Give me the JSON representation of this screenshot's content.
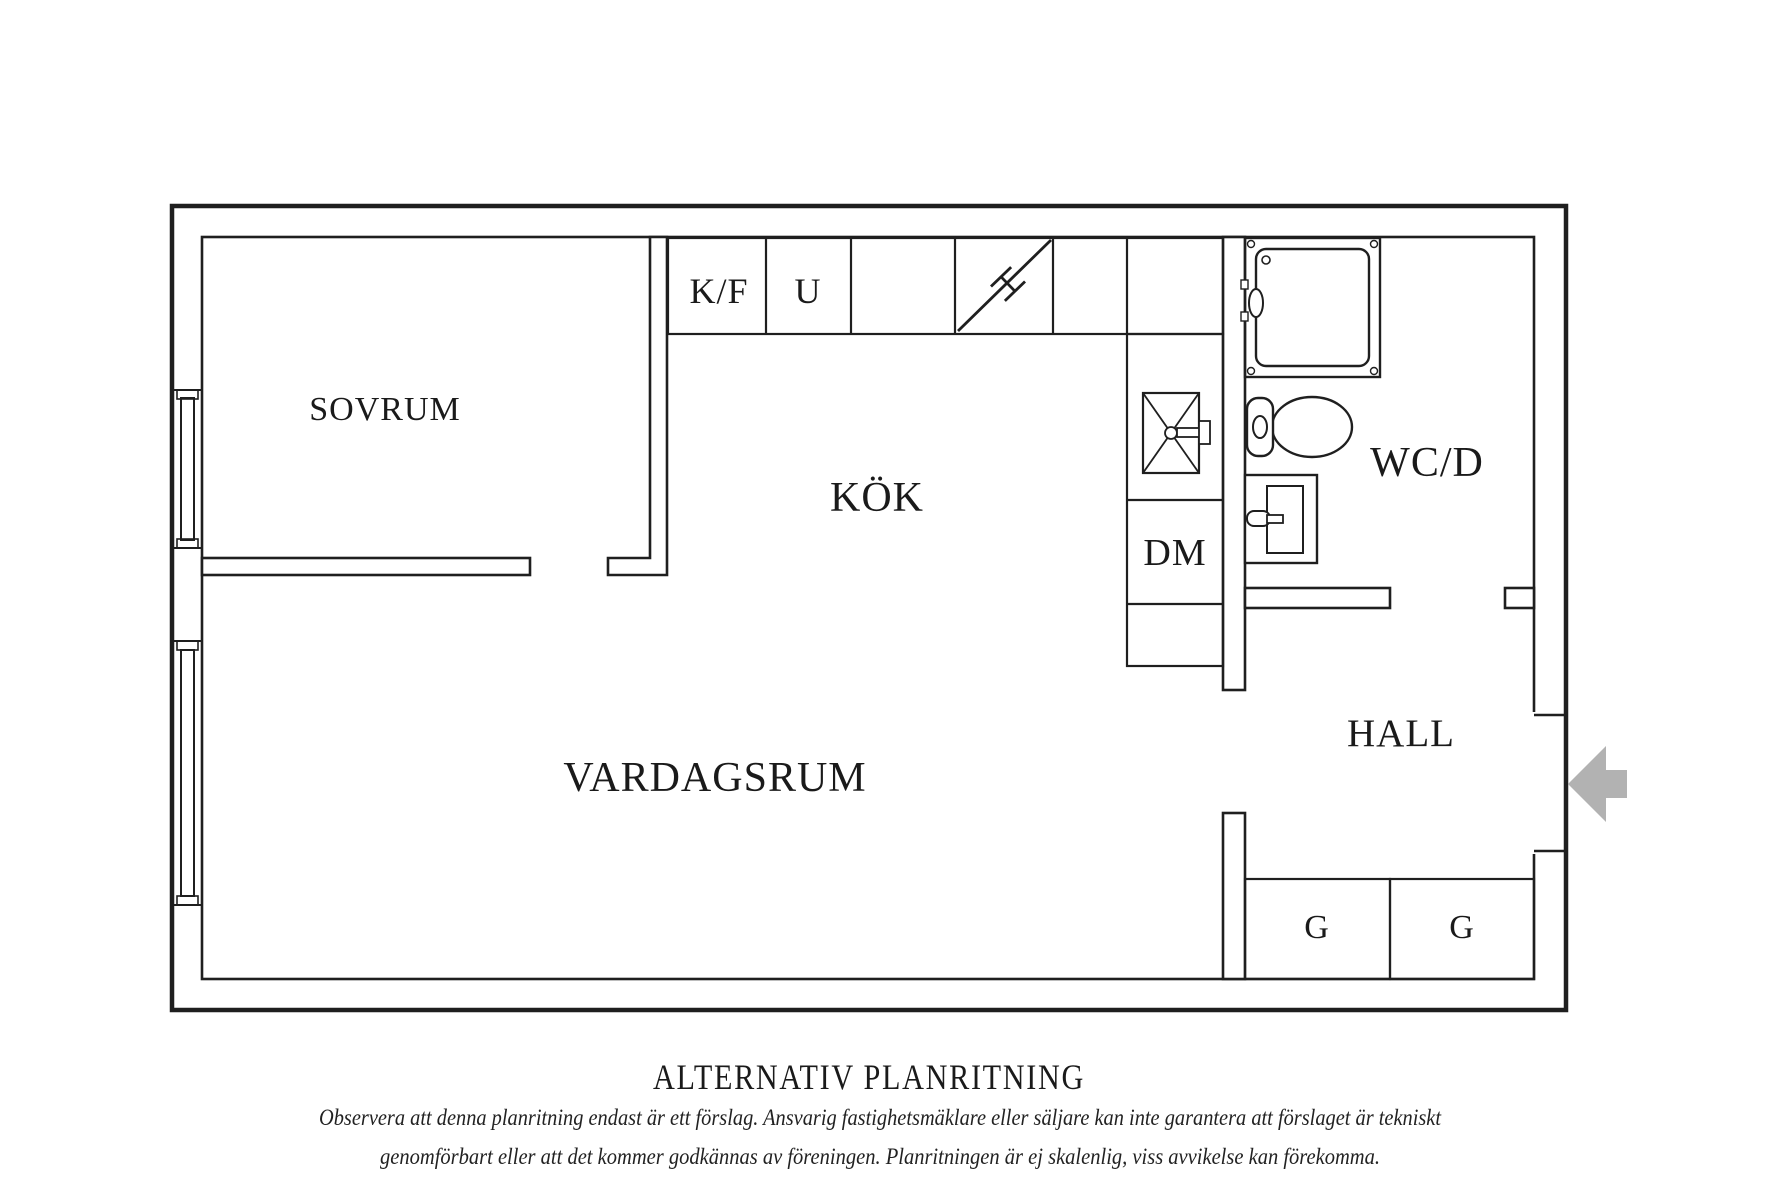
{
  "title": "ALTERNATIV PLANRITNING",
  "disclaimer": {
    "line1": "Observera att denna planritning endast är ett förslag. Ansvarig fastighetsmäklare eller säljare kan inte garantera att förslaget är tekniskt",
    "line2": "genomförbart eller att det kommer godkännas av föreningen. Planritningen är ej skalenlig, viss avvikelse kan förekomma."
  },
  "plan": {
    "rooms": {
      "sovrum": "SOVRUM",
      "kok": "KÖK",
      "vardagsrum": "VARDAGSRUM",
      "wcd": "WC/D",
      "hall": "HALL"
    },
    "fixtures": {
      "kyl_frys": "K/F",
      "ugn": "U",
      "diskmaskin": "DM",
      "closet_left": "G",
      "closet_right": "G"
    },
    "icons": {
      "stove": "hob-diagonal-icon",
      "sink": "kitchen-sink-icon",
      "shower": "shower-cabin-icon",
      "toilet": "toilet-icon",
      "washbasin": "washbasin-icon",
      "entry": "entry-arrow-icon",
      "windows": "window-icon"
    }
  },
  "colors": {
    "line": "#1f1f1f",
    "arrow": "#b2b2b2",
    "background": "#ffffff"
  }
}
